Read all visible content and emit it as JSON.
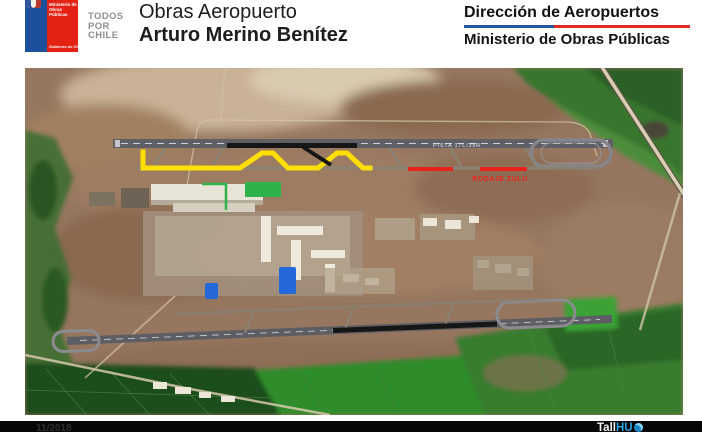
{
  "page": {
    "background": "#ffffff"
  },
  "header": {
    "logo": {
      "ministry_lines": [
        "Ministerio de",
        "Obras Públicas"
      ],
      "government": "Gobierno de Chile",
      "blue": "#1c4f9c",
      "red": "#e32213",
      "emblem_icon": "chile-coat-of-arms"
    },
    "slogan": {
      "lines": [
        "TODOS",
        "POR",
        "CHILE"
      ],
      "color": "#8f8f8f"
    },
    "title": {
      "line1": "Obras Aeropuerto",
      "line2": "Arturo Merino Benítez"
    },
    "department": {
      "line1": "Dirección de Aeropuertos",
      "line2": "Ministerio de Obras Públicas",
      "divider_blue": "#2355a4",
      "divider_red": "#e02b20"
    }
  },
  "map": {
    "type": "satellite-annotated",
    "labels": {
      "runway_north": "PISTA 17L/35R",
      "taxiway_zulu": "RODAJE ZULU"
    },
    "annotations": {
      "yellow_taxiway": {
        "color": "#ffdf00"
      },
      "black_runway_north": {
        "color": "#161616"
      },
      "red_taxiway_zulu": {
        "color": "#e8231a"
      },
      "green_apron": {
        "color": "#2db34a"
      },
      "blue_platforms": {
        "color": "#2468d9"
      },
      "black_runway_south": {
        "color": "#161616"
      }
    }
  },
  "footer": {
    "date": "11/2018",
    "brand": {
      "white": "Tall",
      "blue": "HU",
      "globe_icon": "globe-icon"
    }
  }
}
